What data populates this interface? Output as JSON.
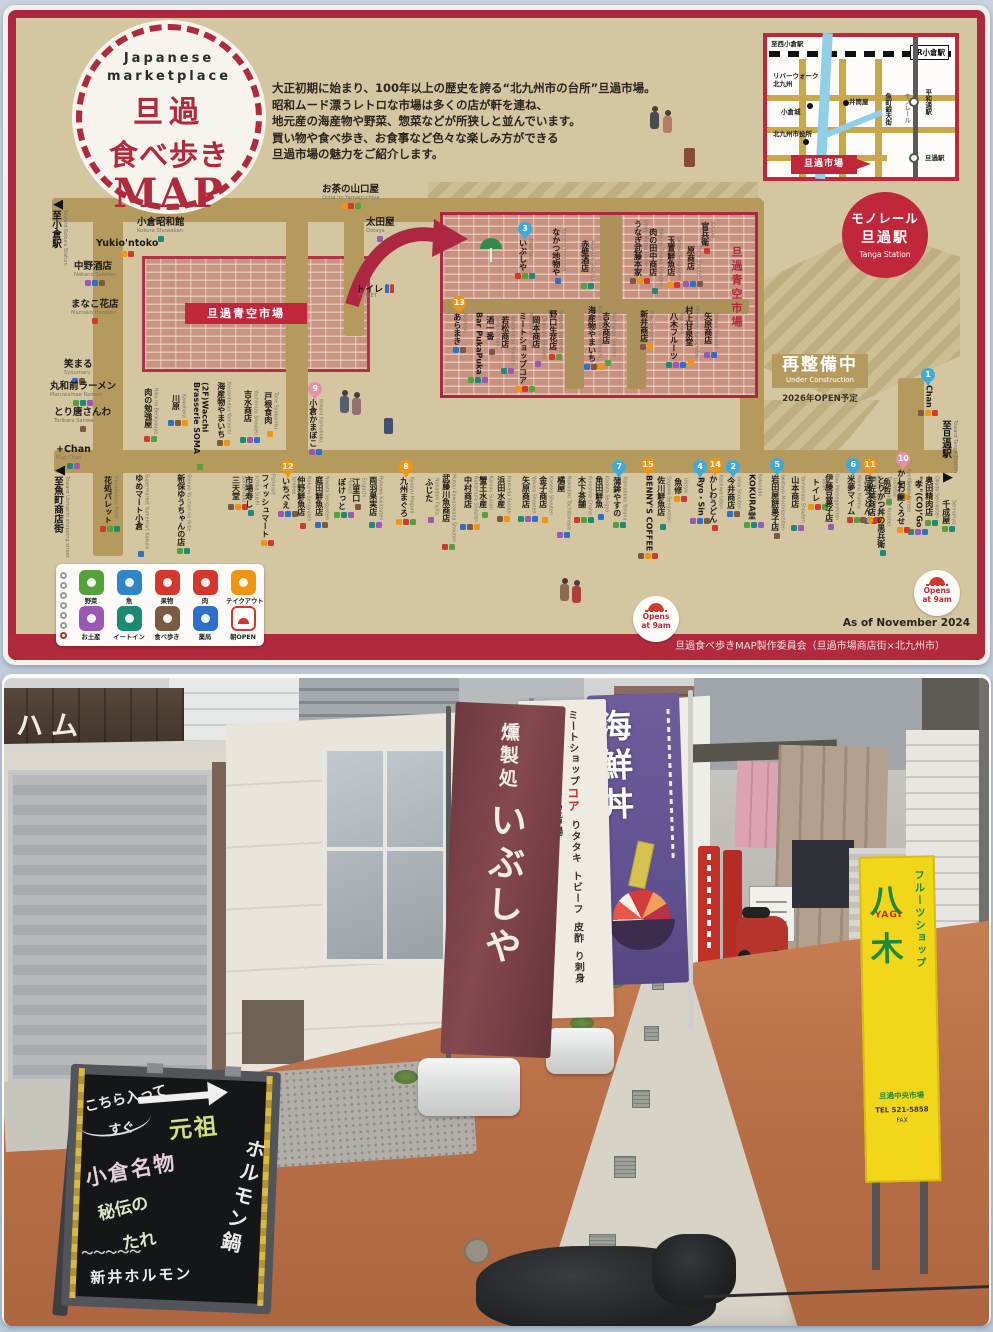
{
  "map": {
    "logo": {
      "en": "Japanese\nmarketplace",
      "jp1": "旦過",
      "jp2": "食べ歩き",
      "jp3": "MAP"
    },
    "intro": "大正初期に始まり、100年以上の歴史を誇る“北九州市の台所”旦過市場。\n昭和ムード漂うレトロな市場は多くの店が軒を連ね、\n地元産の海産物や野菜、惣菜などが所狭しと並んでいます。\n買い物や食べ歩き、お食事など色々な楽しみ方ができる\n旦過市場の魅力をご紹介します。",
    "minimap": {
      "nishikokura": "至西小倉駅",
      "jr": "JR小倉駅",
      "riverwalk": "リバーウォーク\n北九州",
      "izutsuya": "井筒屋",
      "castle": "小倉城",
      "cityhall": "北九州市役所",
      "uomachi": "魚町銀天街",
      "monorail": "モノレール",
      "heiwadori": "平和通駅",
      "tangaeki": "旦過駅",
      "tangaichiba": "旦過市場"
    },
    "station_badge": {
      "l1": "モノレール",
      "l2": "旦過駅",
      "l3": "Tanga Station"
    },
    "construction": {
      "jp": "再整備中",
      "en": "Under Construction",
      "note": "2026年OPEN予定"
    },
    "aozora": "旦過青空市場",
    "toilet": {
      "jp": "トイレ",
      "en": "TOILET"
    },
    "opens_badge": {
      "l1": "Opens",
      "l2": "at 9am"
    },
    "asof": "As of November 2024",
    "credit": "旦過食べ歩きMAP製作委員会（旦過市場商店街×北九州市）",
    "icon_palette": [
      "#1d8a74",
      "#ef9413",
      "#9b59b6",
      "#d4372c",
      "#2d6fc9",
      "#55a13c",
      "#7a5b42"
    ],
    "directions": [
      {
        "jp": "至小倉駅",
        "en": "Toward Kokura Station",
        "x": 48,
        "y": 200,
        "arr": "◀"
      },
      {
        "jp": "至魚町商店街",
        "en": "Toward Uomachi shopping street",
        "x": 50,
        "y": 466,
        "arr": "◀"
      },
      {
        "jp": "至旦過駅",
        "en": "Toward Tanga Station",
        "x": 938,
        "y": 420,
        "arr": "▶"
      }
    ],
    "shops": [
      {
        "j": "小倉昭和館",
        "e": "Kokura Showakan",
        "x": 137,
        "y": 214,
        "o": "h"
      },
      {
        "j": "Yukio'ntoko",
        "e": "",
        "x": 96,
        "y": 238,
        "o": "h"
      },
      {
        "j": "中野酒店",
        "e": "Nakano Saketen",
        "x": 74,
        "y": 258,
        "o": "h"
      },
      {
        "j": "まなこ花店",
        "e": "Mamako Hanaten",
        "x": 71,
        "y": 296,
        "o": "h"
      },
      {
        "j": "笑まる",
        "e": "Syoumaru",
        "x": 64,
        "y": 356,
        "o": "h"
      },
      {
        "j": "丸和前ラーメン",
        "e": "Maruwamae Ramen",
        "x": 50,
        "y": 378,
        "o": "h"
      },
      {
        "j": "とり唐さんわ",
        "e": "Torikara Sanwa",
        "x": 54,
        "y": 404,
        "o": "h"
      },
      {
        "j": "+Chan",
        "e": "Plus Chan",
        "x": 56,
        "y": 444,
        "o": "h"
      },
      {
        "j": "お茶の山口屋",
        "e": "Ocha no Yamaguchiya",
        "x": 322,
        "y": 181,
        "o": "h"
      },
      {
        "j": "太田屋",
        "e": "Ootaya",
        "x": 366,
        "y": 214,
        "o": "h"
      },
      {
        "j": "肉の勉強屋",
        "e": "Niku no Benkyouya",
        "x": 143,
        "y": 388,
        "o": "v"
      },
      {
        "j": "川原",
        "e": "Kawahara",
        "x": 168,
        "y": 394,
        "o": "v"
      },
      {
        "j": "(2F)Wacchi Brasserie SOMA",
        "e": "",
        "x": 191,
        "y": 382,
        "o": "v"
      },
      {
        "j": "海産物やまいち",
        "e": "Kaisanbutsu Yamaichi",
        "x": 216,
        "y": 382,
        "o": "v"
      },
      {
        "j": "吉水商店",
        "e": "Yoshimizu Shouten",
        "x": 240,
        "y": 390,
        "o": "v"
      },
      {
        "j": "戸根食肉",
        "e": "Tone Syokuniku",
        "x": 263,
        "y": 392,
        "o": "v"
      },
      {
        "j": "小倉かまぼこ",
        "e": "Kokura Kamaboko",
        "x": 308,
        "y": 382,
        "o": "v",
        "p": [
          9,
          "p"
        ]
      },
      {
        "j": "いぶしや",
        "e": "Ibushiya",
        "x": 515,
        "y": 222,
        "o": "v",
        "p": [
          3,
          "b"
        ]
      },
      {
        "j": "なかつ地物や",
        "e": "Nakatsu Jimonoya",
        "x": 551,
        "y": 228,
        "o": "v"
      },
      {
        "j": "赤壁酒店",
        "e": "Akakabe Saketen",
        "x": 580,
        "y": 240,
        "o": "v"
      },
      {
        "j": "うなぎ武藤本家",
        "e": "Unagi Mutou Honke",
        "x": 630,
        "y": 220,
        "o": "v"
      },
      {
        "j": "肉の田中商店",
        "e": "Niku no Tanaka Shouten",
        "x": 648,
        "y": 228,
        "o": "v"
      },
      {
        "j": "玉置鮮魚店",
        "e": "Tamaki Sengyoten",
        "x": 666,
        "y": 236,
        "o": "v"
      },
      {
        "j": "原商店",
        "e": "Hara Shouten",
        "x": 683,
        "y": 246,
        "o": "v"
      },
      {
        "j": "官兵衛",
        "e": "Kanbei",
        "x": 700,
        "y": 222,
        "o": "v"
      },
      {
        "j": "あらまき",
        "e": "Aramaki",
        "x": 452,
        "y": 296,
        "o": "v",
        "p": [
          13,
          "o"
        ]
      },
      {
        "j": "Bar PukaPuka",
        "e": "",
        "x": 468,
        "y": 312,
        "o": "v"
      },
      {
        "j": "酒一番",
        "e": "Sake Ichiban",
        "x": 485,
        "y": 316,
        "o": "v"
      },
      {
        "j": "若松商店",
        "e": "Wakamatsu Shouten",
        "x": 500,
        "y": 316,
        "o": "v"
      },
      {
        "j": "ミートショップコア",
        "e": "Meatshop Core",
        "x": 515,
        "y": 312,
        "o": "v"
      },
      {
        "j": "岡本商店",
        "e": "Okamoto Shouten",
        "x": 531,
        "y": 316,
        "o": "v"
      },
      {
        "j": "野口生花店",
        "e": "Noguchi Seikaten",
        "x": 548,
        "y": 310,
        "o": "v"
      },
      {
        "j": "海産物やまいち",
        "e": "Kaisanbutsu Yamaichi",
        "x": 584,
        "y": 306,
        "o": "v"
      },
      {
        "j": "吉永商店",
        "e": "Yoshinaga Shouten",
        "x": 601,
        "y": 312,
        "o": "v"
      },
      {
        "j": "新井商店",
        "e": "Arai Shouten",
        "x": 639,
        "y": 310,
        "o": "v"
      },
      {
        "j": "八木フルーツ",
        "e": "Yagi Fruit",
        "x": 666,
        "y": 312,
        "o": "v"
      },
      {
        "j": "村上甘泉堂",
        "e": "Murakami Kansendou",
        "x": 684,
        "y": 306,
        "o": "v"
      },
      {
        "j": "矢原商店",
        "e": "Yahara Shouten",
        "x": 703,
        "y": 312,
        "o": "v"
      },
      {
        "j": "花処パレット",
        "e": "Hanadokoro Palet",
        "x": 100,
        "y": 476,
        "o": "v"
      },
      {
        "j": "ゆめマート小倉",
        "e": "Supermarket Yumemart Kokura",
        "x": 134,
        "y": 474,
        "o": "v"
      },
      {
        "j": "新保ゆうちゃんの店",
        "e": "Shinpo Yu-chan no mise",
        "x": 176,
        "y": 474,
        "o": "v"
      },
      {
        "j": "三天堂",
        "e": "Santendou",
        "x": 228,
        "y": 476,
        "o": "v"
      },
      {
        "j": "市場寿し",
        "e": "Ichiba Sushi",
        "x": 244,
        "y": 476,
        "o": "v"
      },
      {
        "j": "フィッシュマート",
        "e": "Fishmart",
        "x": 260,
        "y": 474,
        "o": "v"
      },
      {
        "j": "いちべえ",
        "e": "Ichibee",
        "x": 278,
        "y": 460,
        "o": "v",
        "p": [
          12,
          "o"
        ]
      },
      {
        "j": "仲野鮮魚店",
        "e": "Nakano Sengyoten",
        "x": 296,
        "y": 476,
        "o": "v"
      },
      {
        "j": "庭田鮮魚店",
        "e": "Niwata Sengyoten",
        "x": 314,
        "y": 476,
        "o": "v"
      },
      {
        "j": "ぽけっと",
        "e": "Pocket",
        "x": 334,
        "y": 478,
        "o": "v"
      },
      {
        "j": "江里口",
        "e": "Eriguchi",
        "x": 351,
        "y": 478,
        "o": "v"
      },
      {
        "j": "両羽果実店",
        "e": "Ryouwa Kajitsuten",
        "x": 368,
        "y": 476,
        "o": "v"
      },
      {
        "j": "九州まぐろ",
        "e": "Kyusyu Maguro",
        "x": 396,
        "y": 460,
        "o": "v",
        "p": [
          8,
          "o"
        ]
      },
      {
        "j": "ふじた",
        "e": "Nukadaki Fujita",
        "x": 424,
        "y": 478,
        "o": "v"
      },
      {
        "j": "武藤川魚商店",
        "e": "Mutou Kawazakana Shouten",
        "x": 441,
        "y": 474,
        "o": "v"
      },
      {
        "j": "中村商店",
        "e": "Nakamura Shouten",
        "x": 460,
        "y": 476,
        "o": "v"
      },
      {
        "j": "蟹王水産",
        "e": "Kaniou Suisan",
        "x": 478,
        "y": 476,
        "o": "v"
      },
      {
        "j": "浜田水産",
        "e": "Hamada Suisan",
        "x": 496,
        "y": 476,
        "o": "v"
      },
      {
        "j": "矢原商店",
        "e": "Yahara Shouten",
        "x": 518,
        "y": 476,
        "o": "v"
      },
      {
        "j": "金子商店",
        "e": "Kaneko Shouten",
        "x": 538,
        "y": 476,
        "o": "v"
      },
      {
        "j": "橘屋",
        "e": "Nukadaki Tachibanaya",
        "x": 556,
        "y": 476,
        "o": "v"
      },
      {
        "j": "木下茶舗",
        "e": "Kinoshita Chaho",
        "x": 574,
        "y": 476,
        "o": "v"
      },
      {
        "j": "角田鮮魚",
        "e": "Kadota Sengyo",
        "x": 594,
        "y": 476,
        "o": "v"
      },
      {
        "j": "蒲鉾やすの",
        "e": "Kamaboko Yasuno",
        "x": 612,
        "y": 460,
        "o": "v",
        "p": [
          7,
          "b"
        ]
      },
      {
        "j": "BENNY'S COFFEE",
        "e": "",
        "x": 638,
        "y": 458,
        "o": "v",
        "p": [
          15,
          "o"
        ]
      },
      {
        "j": "佐川鮮魚店",
        "e": "Sagawa Sengyoten",
        "x": 656,
        "y": 476,
        "o": "v"
      },
      {
        "j": "魚修",
        "e": "Uosyu",
        "x": 673,
        "y": 478,
        "o": "v"
      },
      {
        "j": "Ryo・Sin",
        "e": "",
        "x": 690,
        "y": 460,
        "o": "v",
        "p": [
          4,
          "b"
        ]
      },
      {
        "j": "かしわうどん",
        "e": "Kashiwa Udon",
        "x": 708,
        "y": 458,
        "o": "v",
        "p": [
          14,
          "o"
        ]
      },
      {
        "j": "今井商店",
        "e": "Imai Shouten",
        "x": 726,
        "y": 460,
        "o": "v",
        "p": [
          2,
          "b"
        ]
      },
      {
        "j": "KOKURA堂",
        "e": "Kokurado",
        "x": 744,
        "y": 474,
        "o": "v"
      },
      {
        "j": "岩田屋餅菓子店",
        "e": "Iwataya Mochikashiten",
        "x": 770,
        "y": 458,
        "o": "v",
        "p": [
          5,
          "b"
        ]
      },
      {
        "j": "山本商店",
        "e": "Yamamoto Shouten",
        "x": 790,
        "y": 476,
        "o": "v"
      },
      {
        "j": "トイレ",
        "e": "Toilet",
        "x": 808,
        "y": 478,
        "o": "v"
      },
      {
        "j": "伊藤豆菓子店",
        "e": "Itou Mamegashiten",
        "x": 824,
        "y": 474,
        "o": "v"
      },
      {
        "j": "米夢マイム",
        "e": "Maimu Maimu",
        "x": 846,
        "y": 458,
        "o": "v",
        "p": [
          6,
          "b"
        ]
      },
      {
        "j": "宇佐美商店",
        "e": "Usami Shouten",
        "x": 864,
        "y": 476,
        "o": "v"
      },
      {
        "j": "魚哲",
        "e": "Uotetsu",
        "x": 882,
        "y": 478,
        "o": "v"
      },
      {
        "j": "旬",
        "e": "Syun",
        "x": 896,
        "y": 480,
        "o": "v"
      },
      {
        "j": "\"孝\"(CO)’Go",
        "e": "",
        "x": 908,
        "y": 476,
        "o": "v"
      },
      {
        "j": "奥田精肉店",
        "e": "Okuda Seinikuten",
        "x": 872,
        "y": 474,
        "o": "v",
        "hide": true
      },
      {
        "j": "旦過うどん",
        "e": "Tanga Udon",
        "x": 884,
        "y": 458,
        "o": "v",
        "p": [
          11,
          "o"
        ],
        "hide": true
      },
      {
        "j": "とりかつ丼の黒兵衛",
        "e": "Torikatsudon Kurobei",
        "x": 898,
        "y": 474,
        "o": "v",
        "hide": true
      },
      {
        "j": "かしわ屋くろせ",
        "e": "Kashiwaya Kurose",
        "x": 914,
        "y": 452,
        "o": "v",
        "p": [
          10,
          "p"
        ],
        "hide": true
      },
      {
        "j": "千成屋",
        "e": "Sennariya",
        "x": 941,
        "y": 500,
        "o": "v"
      },
      {
        "j": "Chan",
        "e": "",
        "x": 918,
        "y": 368,
        "o": "v",
        "p": [
          1,
          "b"
        ]
      }
    ],
    "shops2": [
      {
        "j": "奥田精肉店",
        "e": "Okuda Seinikuten",
        "x": 924,
        "y": 476,
        "o": "v"
      },
      {
        "j": "旦過うどん",
        "e": "Tanga Udon",
        "x": 860,
        "y": 458,
        "o": "v",
        "p": [
          11,
          "o"
        ]
      },
      {
        "j": "とりかつ丼の黒兵衛",
        "e": "Torikatsudon Kurobei",
        "x": 876,
        "y": 476,
        "o": "v"
      },
      {
        "j": "かしわ屋くろせ",
        "e": "Kashiwaya Kurose",
        "x": 896,
        "y": 452,
        "o": "v",
        "p": [
          10,
          "p"
        ]
      }
    ],
    "legend": [
      {
        "label": "野菜",
        "color": "#55a13c"
      },
      {
        "label": "魚",
        "color": "#2e86c8"
      },
      {
        "label": "果物",
        "color": "#d4372c"
      },
      {
        "label": "肉",
        "color": "#d4372c"
      },
      {
        "label": "テイクアウト",
        "color": "#ef9413"
      },
      {
        "label": "お土産",
        "color": "#9b59b6"
      },
      {
        "label": "イートイン",
        "color": "#1d8a74"
      },
      {
        "label": "食べ歩き",
        "color": "#7a5b42"
      },
      {
        "label": "薬局",
        "color": "#2d6fc9"
      },
      {
        "label": "朝OPEN",
        "color": "#ffffff",
        "special": true
      }
    ]
  },
  "photo": {
    "ham_sign": "ハム",
    "ibushiya": {
      "top": "燻製処",
      "main": "いぶしや"
    },
    "menu_banner": {
      "shop1": "ミートショップ",
      "shop2": "コア",
      "items": [
        "りタタキ",
        "トビーフ",
        "皮酢",
        "り刺身",
        "ミガー",
        "豚足",
        "他",
        "空市場"
      ]
    },
    "kaisendon": "海鮮丼",
    "yagi": {
      "type": "フルーツショップ",
      "n1": "八",
      "n2": "木",
      "romaji": "YAGI",
      "addr": "旦過中央市場",
      "tel": "TEL 521-5858",
      "fax": "FAX"
    },
    "chalkboard": {
      "l1": "こちら入って",
      "l2": "すぐ",
      "l3": "元祖",
      "l4": "小倉名物",
      "l5": "ホルモン鍋",
      "l6": "秘伝の",
      "l7": "たれ",
      "wave": "〜〜〜〜〜",
      "l8": "新井ホルモン"
    }
  }
}
